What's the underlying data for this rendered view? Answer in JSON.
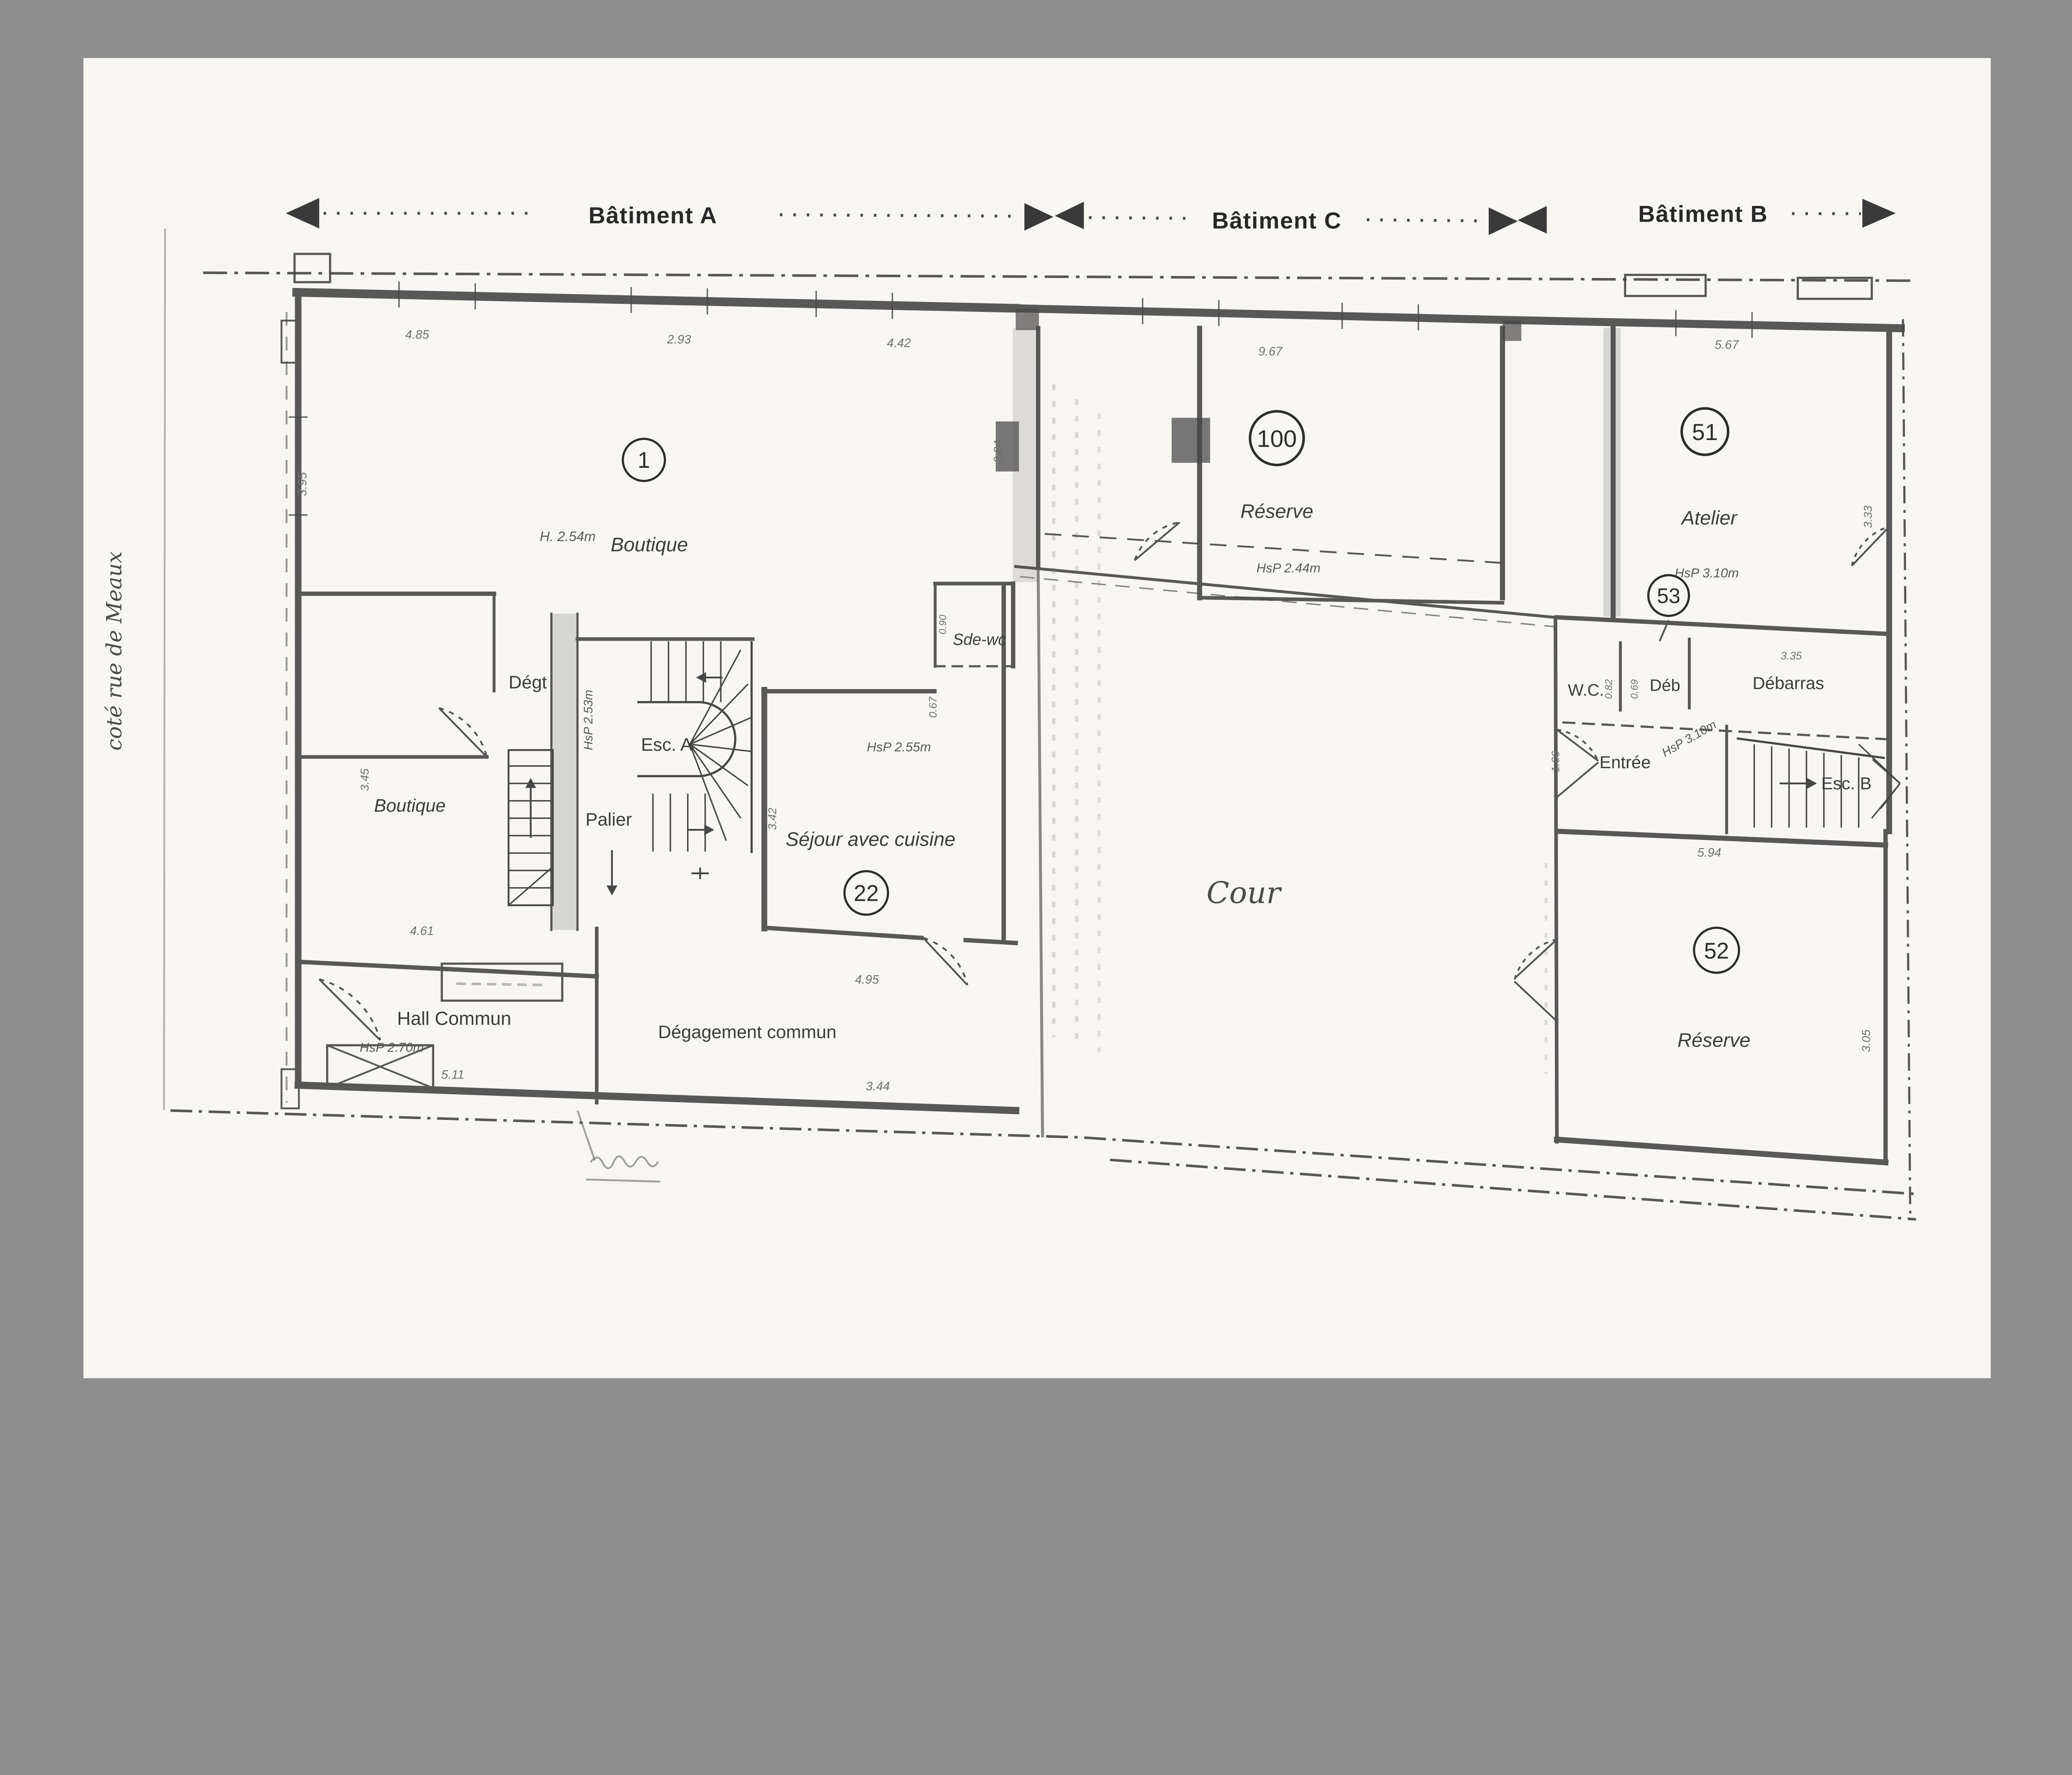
{
  "scan": {
    "background": "#8e8e8e",
    "paper": "#f7f6f2"
  },
  "header": {
    "batiment_a": "Bâtiment A",
    "batiment_c": "Bâtiment C",
    "batiment_b": "Bâtiment B"
  },
  "street": {
    "label": "coté rue de Meaux"
  },
  "rooms": {
    "boutique1": {
      "num": "1",
      "label": "Boutique",
      "note": "H. 2.54m"
    },
    "reserve100": {
      "num": "100",
      "label": "Réserve",
      "note": "HsP 2.44m"
    },
    "atelier51": {
      "num": "51",
      "label": "Atelier",
      "note": "HsP 3.10m"
    },
    "room53": {
      "num": "53"
    },
    "sejour22": {
      "num": "22",
      "label": "Séjour avec cuisine",
      "note": "HsP 2.55m"
    },
    "reserve52": {
      "num": "52",
      "label": "Réserve"
    },
    "boutique_bas": {
      "label": "Boutique"
    },
    "degt": {
      "label": "Dégt"
    },
    "esc_a": {
      "label": "Esc. A"
    },
    "palier": {
      "label": "Palier",
      "note": "HsP 2.53m"
    },
    "sde_wc": {
      "label": "Sde-wc"
    },
    "wc": {
      "label": "W.C."
    },
    "deb": {
      "label": "Déb"
    },
    "debarras": {
      "label": "Débarras"
    },
    "entree": {
      "label": "Entrée"
    },
    "esc_b": {
      "label": "Esc. B",
      "note": "HsP 3.10m"
    },
    "hall": {
      "label": "Hall Commun",
      "note": "HsP 2.70m"
    },
    "degagement": {
      "label": "Dégagement commun"
    },
    "cour": {
      "label": "Cour"
    }
  },
  "dims": {
    "a1": "4.85",
    "a2": "2.93",
    "a3": "4.42",
    "c_top": "9.67",
    "b_top": "5.67",
    "a_left": "3.95",
    "c_left": "2.84",
    "b_right": "3.33",
    "bb_h": "3.45",
    "bb_w": "4.61",
    "sej_h": "3.42",
    "sej_w": "4.95",
    "sde_h": "0.90",
    "sde_b": "0.67",
    "hall_w": "5.11",
    "deg_w": "3.44",
    "wc_w": "0.82",
    "deb_w": "0.69",
    "debarras_w": "3.35",
    "ent_h": "1.06",
    "r52_w": "5.94",
    "r52_h": "3.05"
  }
}
